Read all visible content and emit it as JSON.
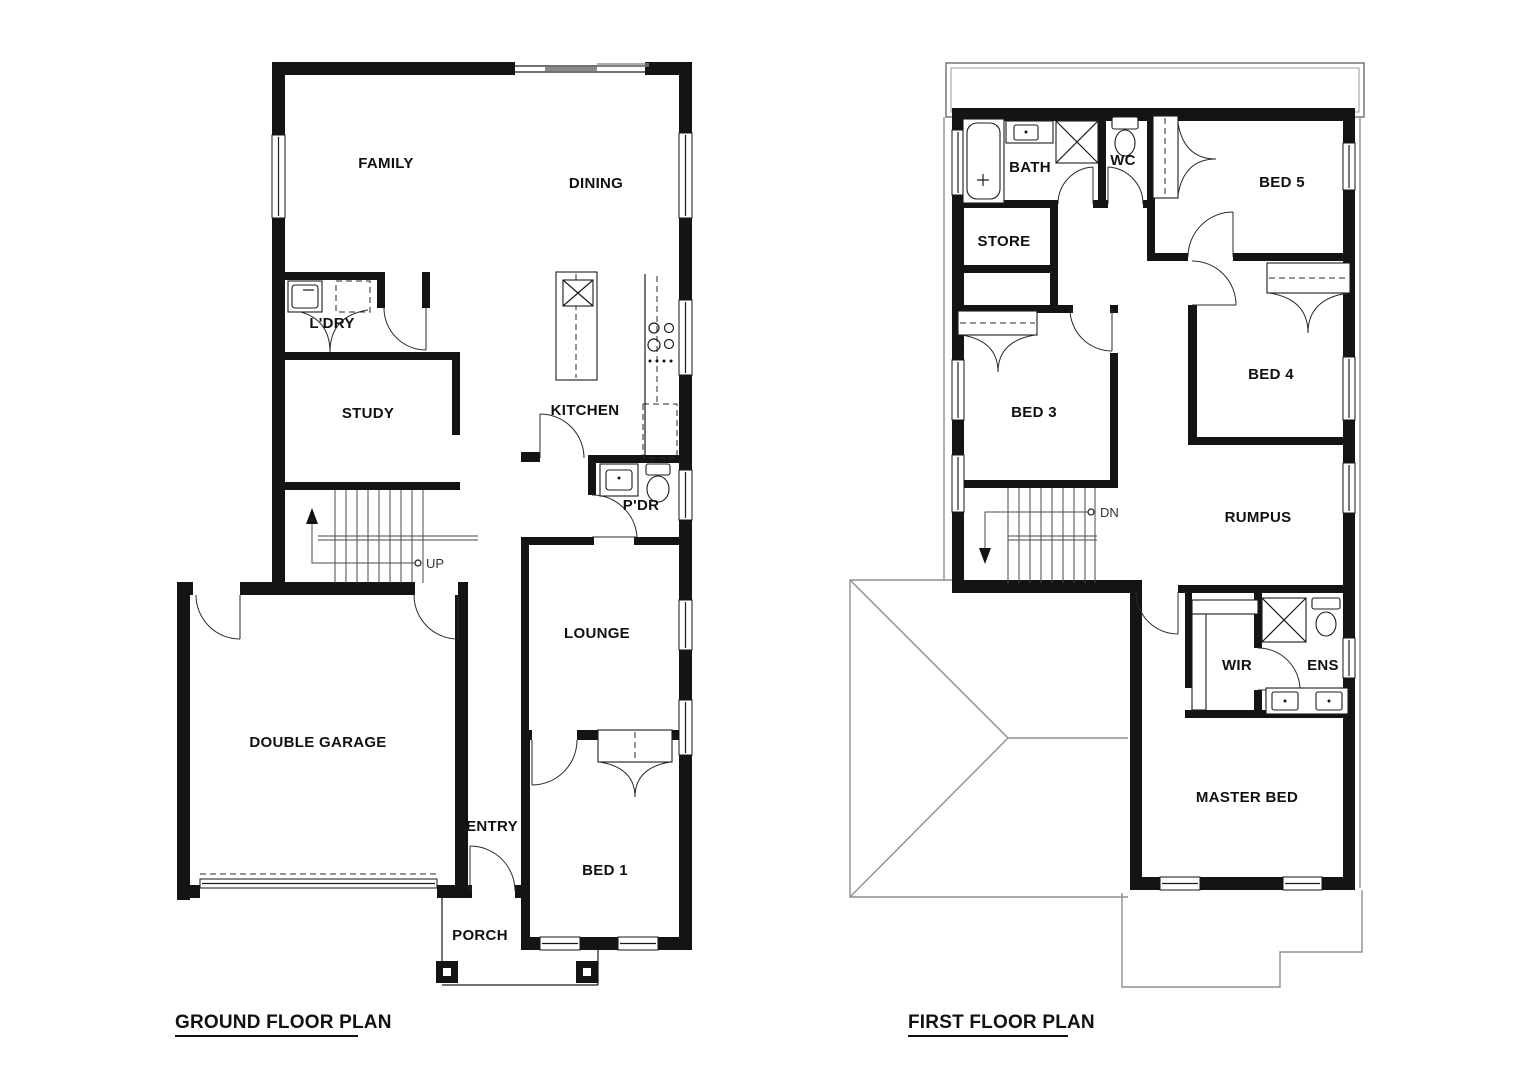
{
  "colors": {
    "wall": "#141414",
    "roof_line": "#8f8f8f",
    "background": "#ffffff"
  },
  "ground": {
    "title": "GROUND FLOOR PLAN",
    "stair_direction": "UP",
    "rooms": {
      "family": "FAMILY",
      "dining": "DINING",
      "laundry": "L'DRY",
      "study": "STUDY",
      "kitchen": "KITCHEN",
      "powder": "P'DR",
      "lounge": "LOUNGE",
      "garage": "DOUBLE GARAGE",
      "entry": "ENTRY",
      "bed1": "BED 1",
      "porch": "PORCH"
    }
  },
  "first": {
    "title": "FIRST FLOOR PLAN",
    "stair_direction": "DN",
    "rooms": {
      "bath": "BATH",
      "wc": "WC",
      "bed5": "BED 5",
      "store": "STORE",
      "bed3": "BED 3",
      "bed4": "BED 4",
      "rumpus": "RUMPUS",
      "wir": "WIR",
      "ensuite": "ENS",
      "master": "MASTER BED"
    }
  }
}
